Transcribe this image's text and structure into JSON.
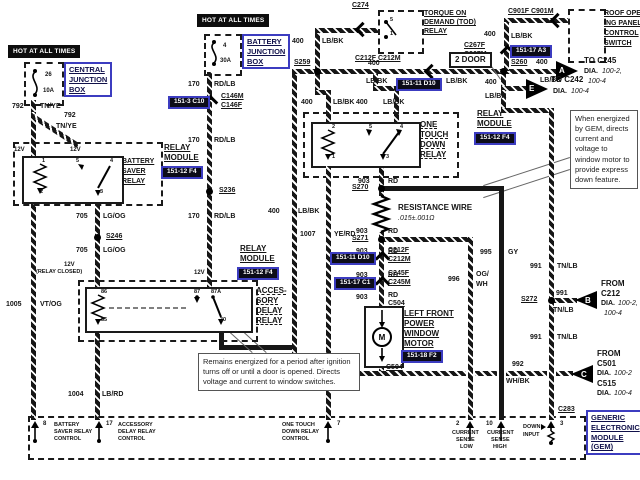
{
  "labels": {
    "hot": "HOT AT ALL TIMES",
    "cjb": {
      "l1": "CENTRAL",
      "l2": "JUNCTION",
      "l3": "BOX",
      "fuse": "26",
      "amp": "10A"
    },
    "bjb": {
      "l1": "BATTERY",
      "l2": "JUNCTION",
      "l3": "BOX",
      "fuse": "4",
      "amp": "30A"
    },
    "relay_module": {
      "l1": "RELAY",
      "l2": "MODULE"
    },
    "bs_relay": {
      "l1": "BATTERY",
      "l2": "SAVER",
      "l3": "RELAY",
      "p1": "1",
      "p2": "2",
      "p3": "3",
      "p4": "4",
      "p5": "5"
    },
    "acc_relay": {
      "l1": "ACCES-",
      "l2": "SORY",
      "l3": "DELAY",
      "l4": "RELAY",
      "p86": "86",
      "p87": "87",
      "p87a": "87A",
      "p85": "85",
      "p30": "30"
    },
    "ot_relay": {
      "l1": "ONE",
      "l2": "TOUCH",
      "l3": "DOWN",
      "l4": "RELAY",
      "p2": "2",
      "p5": "5",
      "p4": "4",
      "p1": "1",
      "p3": "3"
    },
    "tod_relay": {
      "l1": "TORQUE ON",
      "l2": "DEMAND (TOD)",
      "l3": "RELAY",
      "p5": "5",
      "p1": "1"
    },
    "roof": {
      "l1": "ROOF OPEN-",
      "l2": "ING PANEL",
      "l3": "CONTROL",
      "l4": "SWITCH"
    },
    "motor": {
      "l1": "LEFT FRONT",
      "l2": "POWER",
      "l3": "WINDOW",
      "l4": "MOTOR",
      "m": "M"
    },
    "resistance": {
      "l1": "RESISTANCE WIRE",
      "l2": ".015±.001Ω"
    },
    "two_door": "2 DOOR",
    "v12": "12V",
    "relay_closed": "(RELAY CLOSED)",
    "notes": {
      "acc": "Remains energized for a period after ignition turns off or until a door is opened. Directs voltage and current to window switches.",
      "gem": "When energized by GEM, directs current and voltage to window motor to provide express down feature."
    }
  },
  "gem": {
    "l1": "GENERIC",
    "l2": "ELECTRONIC",
    "l3": "MODULE",
    "l4": "(GEM)",
    "c283": "C283",
    "p8": "8",
    "p8l1": "BATTERY",
    "p8l2": "SAVER RELAY",
    "p8l3": "CONTROL",
    "p17": "17",
    "p17l1": "ACCESSORY",
    "p17l2": "DELAY RELAY",
    "p17l3": "CONTROL",
    "p7": "7",
    "p7l1": "ONE TOUCH",
    "p7l2": "DOWN RELAY",
    "p7l3": "CONTROL",
    "p2": "2",
    "p2l1": "CURRENT",
    "p2l2": "SENSE",
    "p2l3": "LOW",
    "p10": "10",
    "p10l1": "CURRENT",
    "p10l2": "SENSE",
    "p10l3": "HIGH",
    "p3": "3",
    "p3l1": "DOWN",
    "p3l2": "INPUT"
  },
  "tags": {
    "t12f4": "151-12 F4",
    "t11d10": "151-11 D10",
    "t17c1": "151-17 C1",
    "t17a3": "151-17 A3",
    "t3c10": "151-3 C10",
    "t18f2": "151-18 F2"
  },
  "connectors": {
    "c274": "C274",
    "c146m": "C146M",
    "c146f": "C146F",
    "c212fm": "C212F C212M",
    "c212f": "C212F",
    "c212m": "C212M",
    "c245f": "C245F",
    "c245m": "C245M",
    "c267f": "C267F",
    "c267m": "C267M",
    "c901fm": "C901F C901M",
    "c504": "C504"
  },
  "splices": {
    "s236": "S236",
    "s246": "S246",
    "s259": "S259",
    "s260": "S260",
    "s270": "S270",
    "s271": "S271",
    "s272": "S272"
  },
  "wires": {
    "n792": "792",
    "tnye": "TN/YE",
    "n170": "170",
    "rdlb": "RD/LB",
    "n400": "400",
    "lbbk": "LB/BK",
    "n705": "705",
    "lgog": "LG/OG",
    "n1005": "1005",
    "vtog": "VT/OG",
    "n1004": "1004",
    "lbrd": "LB/RD",
    "n1007": "1007",
    "yerd": "YE/RD",
    "n903": "903",
    "rd": "RD",
    "n995": "995",
    "gy": "GY",
    "n996": "996",
    "ogwh1": "OG/",
    "ogwh2": "WH",
    "n991": "991",
    "tnlb": "TN/LB",
    "n992": "992",
    "whbk": "WH/BK"
  },
  "arrows": {
    "a": {
      "letter": "A",
      "l1": "TO C245",
      "dia": "DIA.",
      "r1": "100-2,",
      "r2": "100-4"
    },
    "e": {
      "letter": "E",
      "l1": "TO C242",
      "dia": "DIA.",
      "r1": "100-4"
    },
    "b": {
      "letter": "B",
      "l1": "FROM",
      "l2": "C212",
      "dia": "DIA.",
      "r1": "100-2,",
      "r2": "100-4"
    },
    "c": {
      "letter": "C",
      "l1": "FROM",
      "l2": "C501",
      "dia1": "DIA.",
      "r1": "100-2",
      "l3": "C515",
      "dia2": "DIA.",
      "r2": "100-4"
    }
  }
}
